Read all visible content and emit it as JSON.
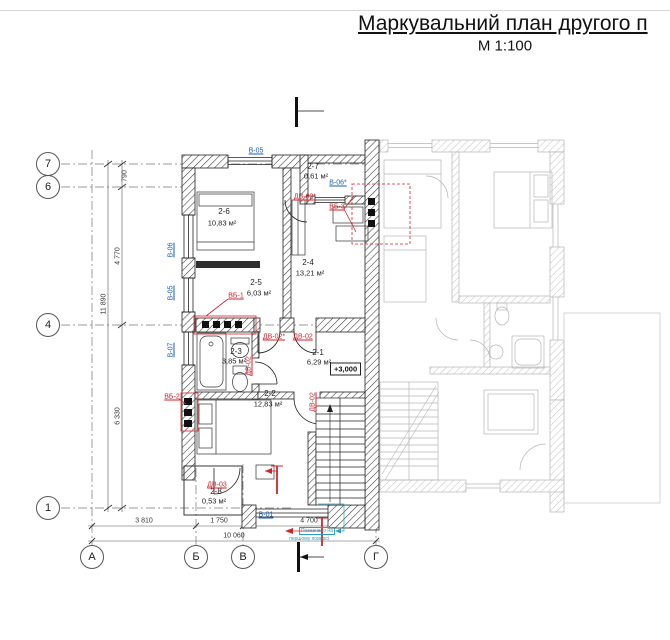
{
  "header": {
    "title": "Маркувальний план другого п",
    "scale": "М 1:100"
  },
  "axes": {
    "left": [
      "7",
      "6",
      "4",
      "1"
    ],
    "bottom": [
      "А",
      "Б",
      "В",
      "Г"
    ]
  },
  "dims": {
    "seg_790": "790",
    "seg_4770": "4 770",
    "seg_6330": "6 330",
    "total_left": "11 890",
    "seg_3810": "3 810",
    "seg_1750": "1 750",
    "seg_4700": "4 700",
    "total_bottom": "10 060"
  },
  "rooms": [
    {
      "number": "2-6",
      "area": "10,83 м²"
    },
    {
      "number": "2-5",
      "area": "6,03 м²"
    },
    {
      "number": "2-4",
      "area": "13,21 м²"
    },
    {
      "number": "2-7",
      "area": "0,61 м²"
    },
    {
      "number": "2-3",
      "area": "3,85 м²"
    },
    {
      "number": "2-1",
      "area": "6,29 м²"
    },
    {
      "number": "2-2",
      "area": "12,83 м²"
    },
    {
      "number": "2-8",
      "area": "0,53 м²"
    }
  ],
  "elevation": "+3,000",
  "marks": {
    "windows": {
      "v05_top": "В-05",
      "v06_left": "В-06",
      "v05_left": "В-05",
      "v07_left": "В-07",
      "v06s_tr": "В-06*",
      "v01_bottom": "В-01"
    },
    "doors": {
      "dv02s_top": "ДВ-02*",
      "vb3": "ВБ-3",
      "vb1": "ВБ-1",
      "dv02s_mid": "ДВ-02*",
      "dv02_mid": "ДВ-02",
      "dv02_bath": "ДВ-02",
      "vb2": "ВБ-2",
      "dv02_stairs": "ДВ-02",
      "dv03": "ДВ-03"
    }
  },
  "note": {
    "line1": "Позначено на",
    "line2": "першому поверсі"
  },
  "colors": {
    "window_mark": "#1a5fb4",
    "door_mark": "#d2232a",
    "note": "#2aa0c8",
    "ink": "#1a1a1a",
    "ghost": "#b6b6b6"
  }
}
